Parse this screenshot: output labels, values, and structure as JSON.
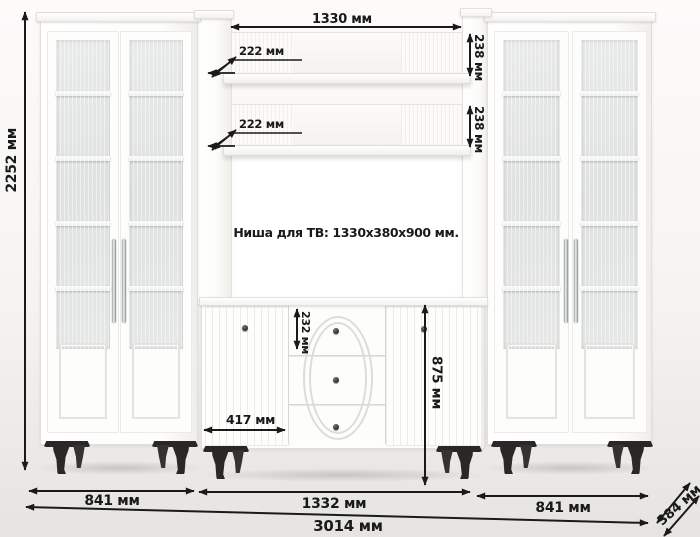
{
  "product": {
    "kind": "furniture-dimension-diagram",
    "description": "white wall unit with two glass-door cabinets, open shelves, TV niche and drawer sideboard"
  },
  "annotations": {
    "tv_niche": "Ниша для ТВ: 1330x380x900 мм."
  },
  "dimensions": {
    "shelf_opening_width": "1330 мм",
    "shelf_depth_upper": "222 мм",
    "shelf_depth_lower": "222 мм",
    "shelf_clearance_upper": "238 мм",
    "shelf_clearance_lower": "238 мм",
    "total_height": "2252 мм",
    "top_drawer_height": "232 мм",
    "sideboard_height": "875 мм",
    "sideboard_door_width": "417 мм",
    "left_cabinet_width": "841 мм",
    "sideboard_width": "1332 мм",
    "right_cabinet_width": "841 мм",
    "total_width": "3014 мм",
    "depth": "384 мм"
  },
  "colors": {
    "dimension_ink": "#1a1a1a",
    "furniture_white": "#ffffff",
    "glass": "#e2e5e4",
    "legs": "#2b2726",
    "background": "#f4f2ef"
  }
}
